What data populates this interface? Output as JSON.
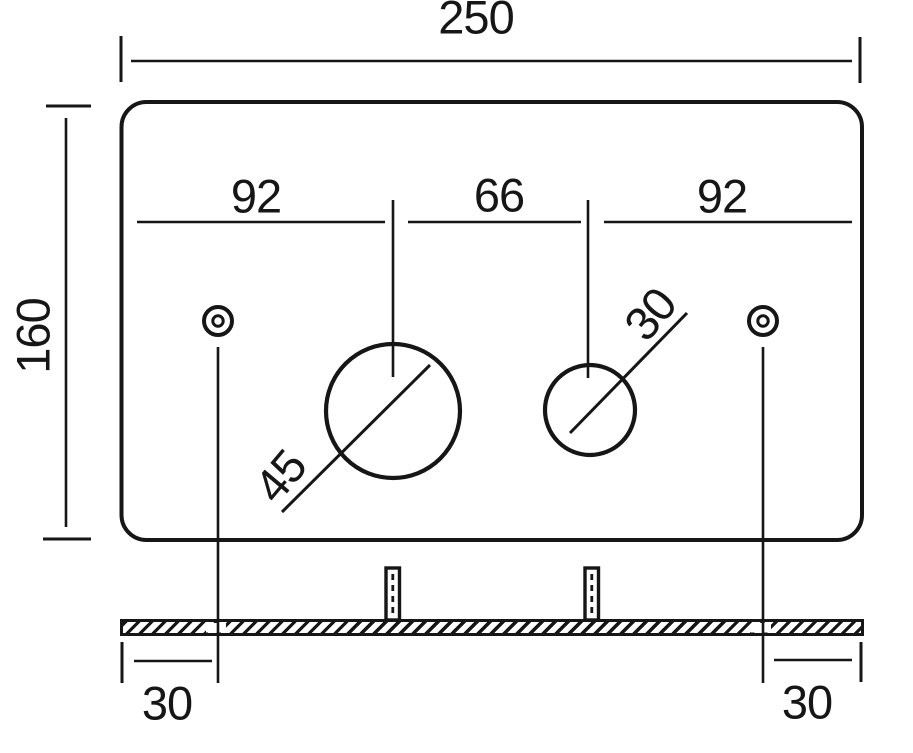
{
  "meta": {
    "ink_color": "#161616",
    "background_color": "#ffffff"
  },
  "front_view": {
    "overall_width_label": "250",
    "overall_height_label": "160",
    "left_span_label": "92",
    "center_span_label": "66",
    "right_span_label": "92",
    "large_hole_diameter_label": "45",
    "small_hole_diameter_label": "30"
  },
  "side_view": {
    "left_screw_offset_label": "30",
    "right_screw_offset_label": "30"
  }
}
